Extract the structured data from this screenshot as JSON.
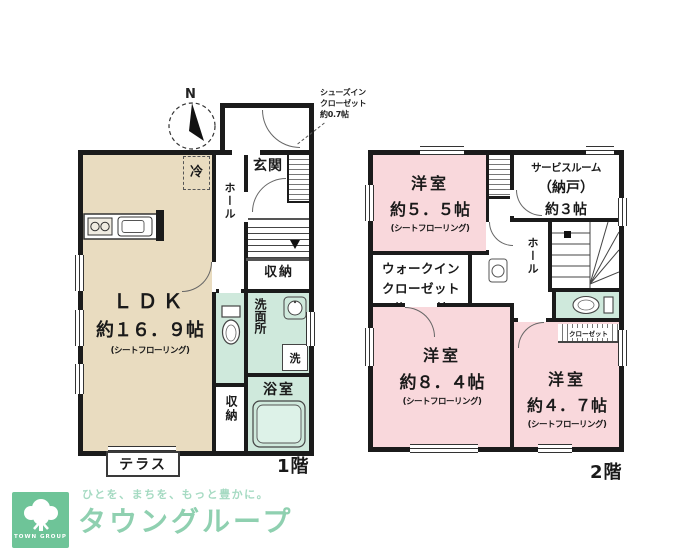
{
  "colors": {
    "wall": "#1b1b1b",
    "ldk_fill": "#e9dcc0",
    "bedroom_fill": "#f9d8dc",
    "wet_fill": "#cfe9dc",
    "logo_green": "#6ec498",
    "logo_text_green": "#8fd0b0"
  },
  "compass": {
    "north_label": "N"
  },
  "floor1": {
    "floor_label": "1階",
    "ldk": {
      "name": "ＬＤＫ",
      "size": "約１６．９帖",
      "flooring": "(シートフローリング)"
    },
    "fridge_label": "冷",
    "genkan_label": "玄関",
    "hall_label": "ホール",
    "shoes_closet_note": {
      "line1": "シューズイン",
      "line2": "クローゼット",
      "line3": "約0.7帖"
    },
    "stairs_storage_label": "収納",
    "washroom_label": "洗面所",
    "washer_label": "洗",
    "bath_label": "浴室",
    "storage_label": "収納",
    "terrace_label": "テラス"
  },
  "floor2": {
    "floor_label": "2階",
    "room_5_5": {
      "name": "洋室",
      "size": "約５．５帖",
      "flooring": "(シートフローリング)"
    },
    "service_room": {
      "line1": "サービスルーム",
      "line2": "（納戸）",
      "line3": "約３帖"
    },
    "wic": {
      "line1": "ウォークイン",
      "line2": "クローゼット",
      "line3": "約２.２帖"
    },
    "hall_label": "ホール",
    "closet_label": "クローゼット",
    "room_8_4": {
      "name": "洋室",
      "size": "約８．４帖",
      "flooring": "(シートフローリング)"
    },
    "room_4_7": {
      "name": "洋室",
      "size": "約４．７帖",
      "flooring": "(シートフローリング)"
    }
  },
  "logo": {
    "brand_name": "TOWN GROUP",
    "tagline": "ひとを、まちを、もっと豊かに。",
    "company": "タウングループ"
  }
}
